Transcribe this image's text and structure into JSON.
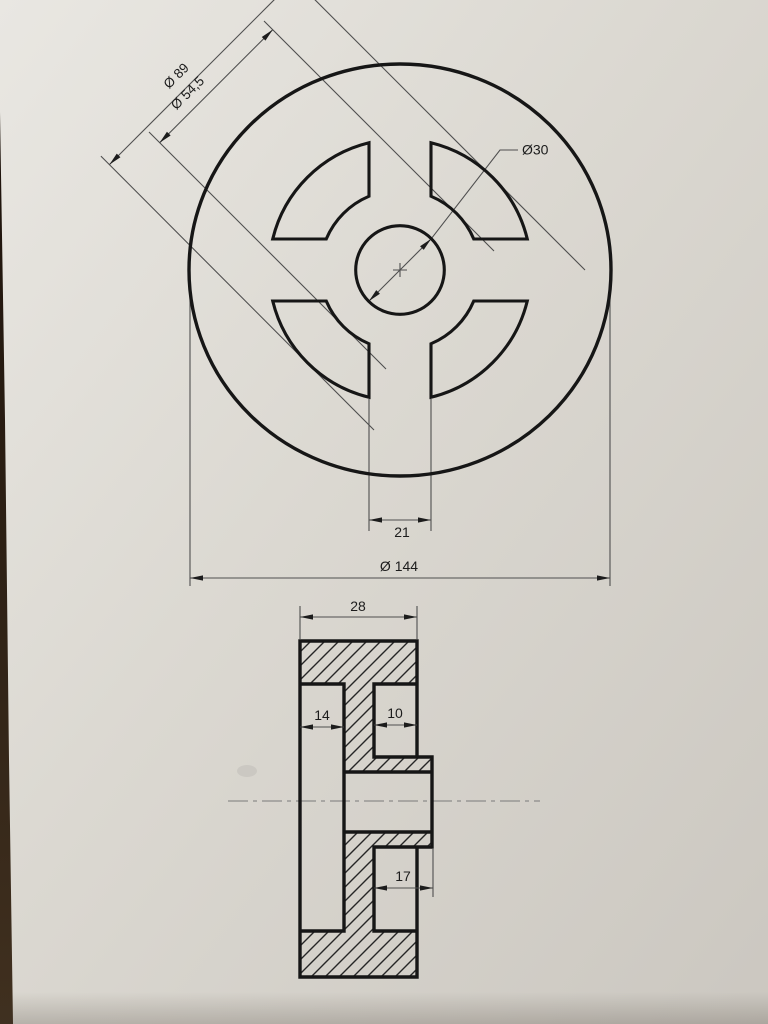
{
  "sheet": {
    "description": "Technical drawing of a slotted wheel (pulley) on paper, top view and sectional side view",
    "colors": {
      "paper": "#dbd8d1",
      "paper_light": "#e9e7e2",
      "paper_dark": "#cbc7c0",
      "ink_thick": "#161616",
      "ink_thin": "#4f4f4f",
      "background_table": "#2a1a10"
    },
    "top_view": {
      "outer_diameter": "Ø 144",
      "slot_outer_diameter": "Ø 89",
      "slot_inner_diameter": "Ø 54,5",
      "bore_diameter": "Ø30",
      "spoke_width": "21"
    },
    "section_view": {
      "overall_width": "28",
      "rim_recess_width": "14",
      "web_width": "10",
      "hub_boss_length": "17"
    }
  }
}
